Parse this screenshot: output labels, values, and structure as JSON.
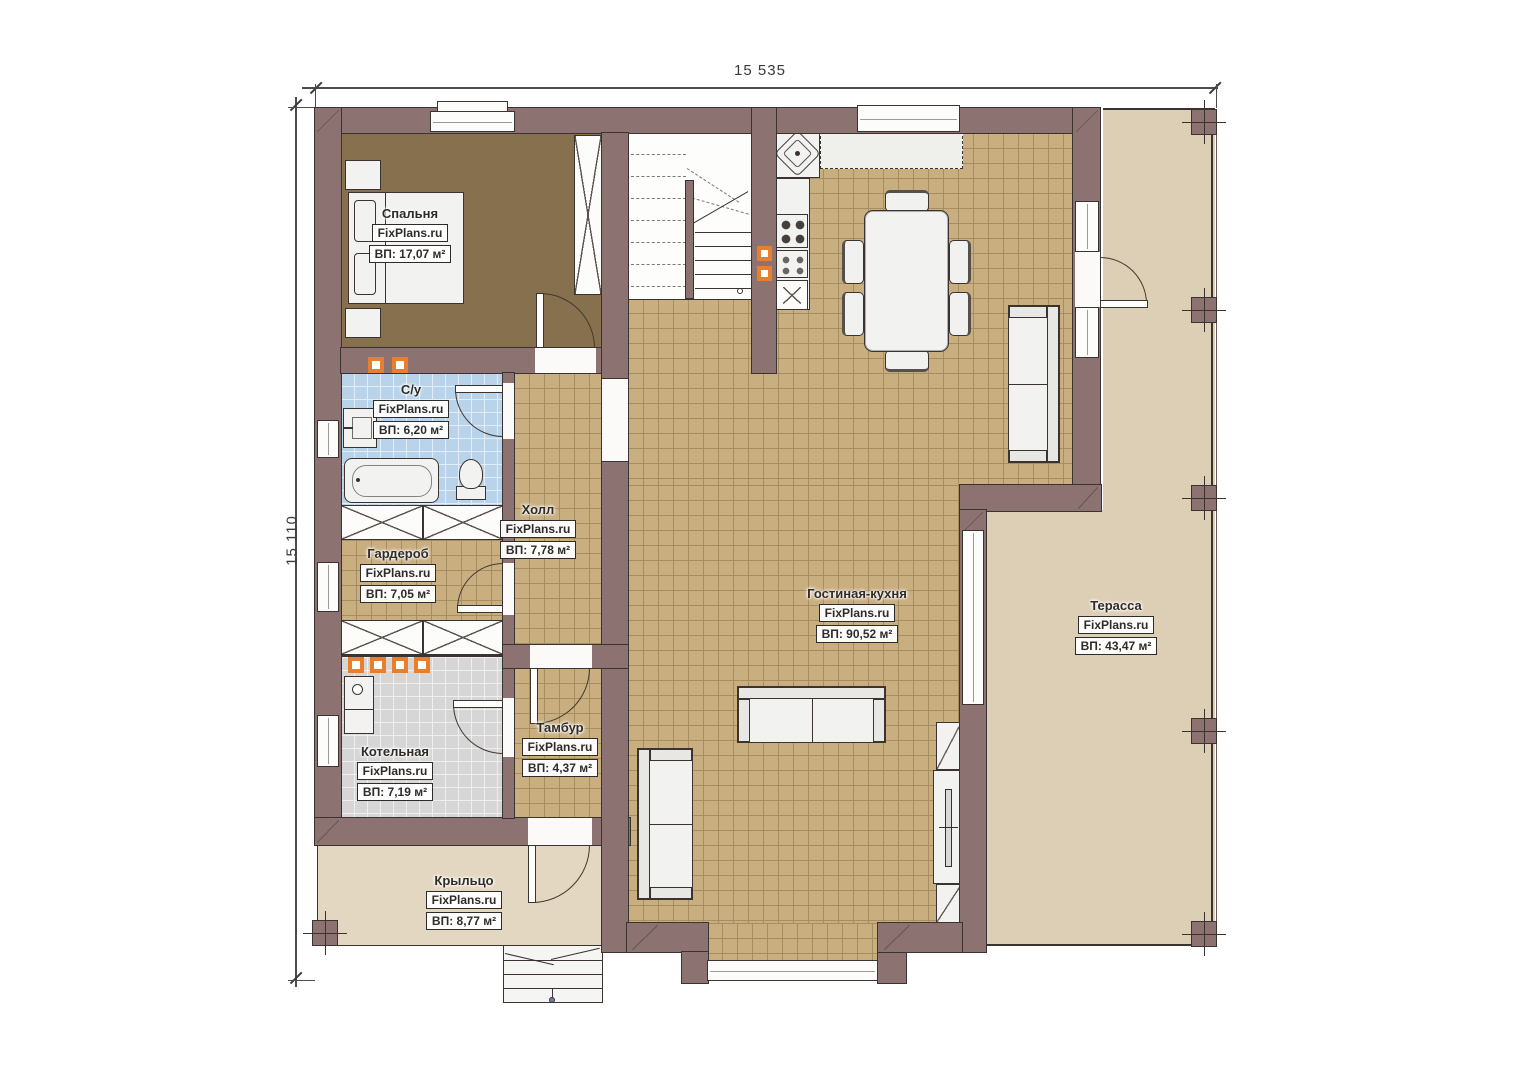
{
  "plan": {
    "brand": "FixPlans.ru",
    "dimensions": {
      "width_label": "15 535",
      "height_label": "15 110"
    },
    "rooms": [
      {
        "name": "Спальня",
        "area": "ВП: 17,07 м²"
      },
      {
        "name": "С/у",
        "area": "ВП: 6,20 м²"
      },
      {
        "name": "Холл",
        "area": "ВП: 7,78 м²"
      },
      {
        "name": "Гардероб",
        "area": "ВП: 7,05 м²"
      },
      {
        "name": "Котельная",
        "area": "ВП: 7,19 м²"
      },
      {
        "name": "Тамбур",
        "area": "ВП: 4,37 м²"
      },
      {
        "name": "Гостиная-кухня",
        "area": "ВП: 90,52 м²"
      },
      {
        "name": "Терасса",
        "area": "ВП: 43,47 м²"
      },
      {
        "name": "Крыльцо",
        "area": "ВП: 8,77 м²"
      }
    ],
    "colors": {
      "wall": "#8c7371",
      "line": "#3b332f",
      "tile": "#c9ae80",
      "tile_line": "#a68e62",
      "bedroom_floor": "#87704d",
      "bath_tile": "#b8d3ea",
      "boiler_tile": "#d6d6d6",
      "terrace": "#ddcfb5",
      "porch": "#e3d7c1",
      "accent_orange": "#e87f2e"
    }
  }
}
